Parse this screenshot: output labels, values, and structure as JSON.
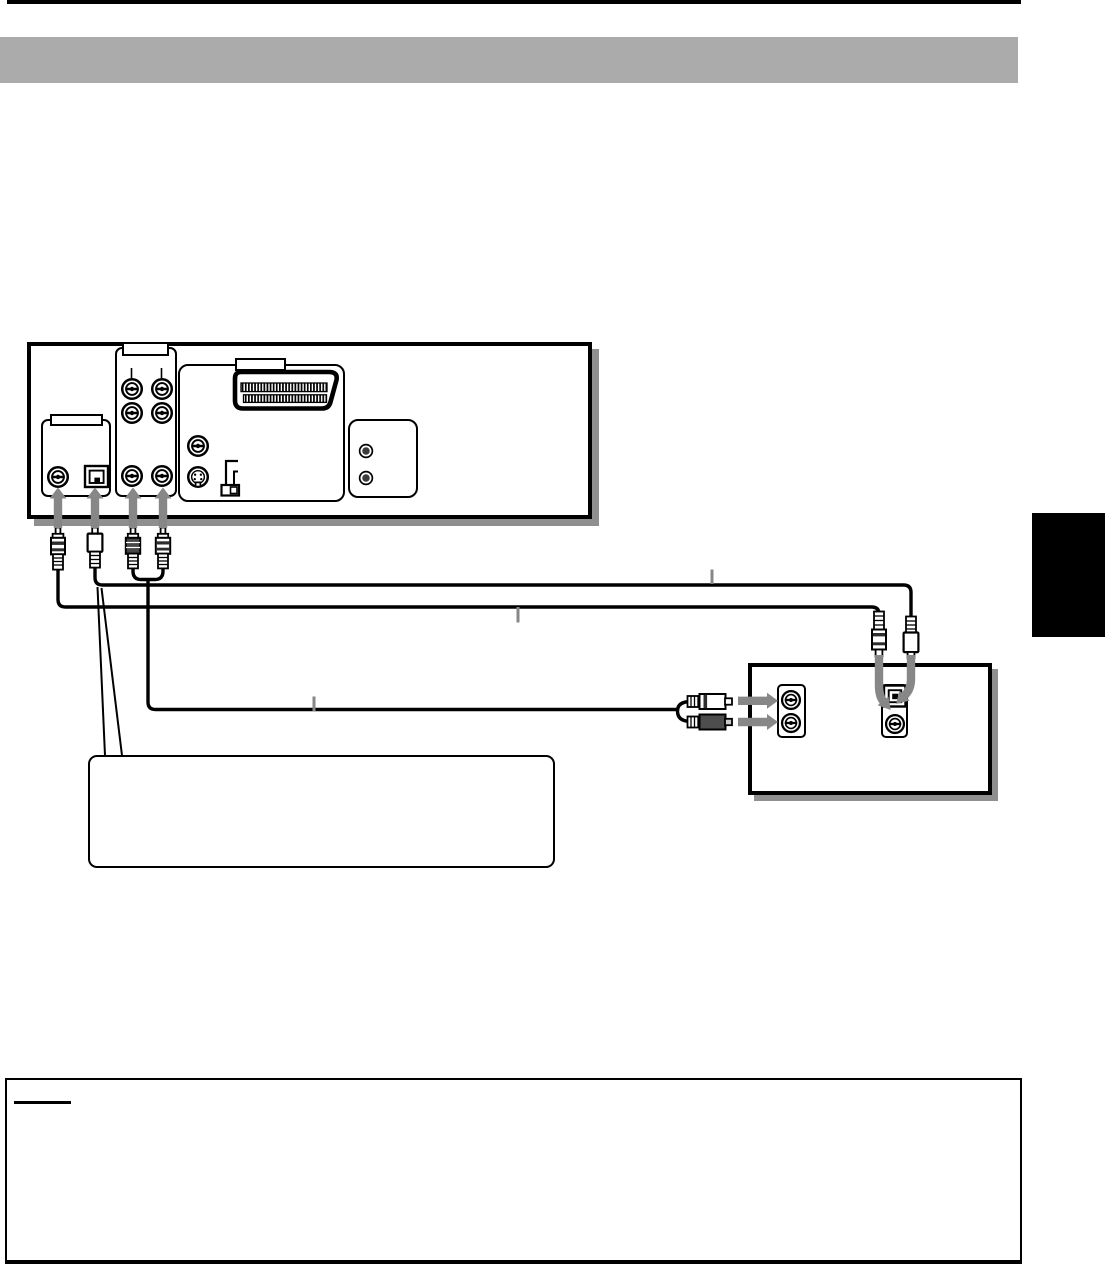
{
  "page": {
    "background": "#ffffff",
    "top_rule_color": "#000000",
    "header_band_color": "#ababab",
    "section_tab_color": "#000000",
    "shadow_color": "#8f8f8f",
    "arrow_color": "#878787",
    "line_color": "#000000"
  },
  "dvd_rear_panel": {
    "label_boxes": [
      {
        "text": ""
      },
      {
        "text": ""
      },
      {
        "text": ""
      }
    ],
    "jacks": [
      "coaxial-digital-out-rca",
      "optical-digital-out",
      "audio-out-rca-top-left",
      "audio-out-rca-top-right",
      "audio-out-rca-mid-left",
      "audio-out-rca-mid-right",
      "audio-out-rca-bottom-left",
      "audio-out-rca-bottom-right",
      "video-out-rca",
      "s-video-out",
      "scart-av-connector",
      "video-output-switch",
      "aux-phono-top",
      "aux-phono-bottom"
    ]
  },
  "amplifier_panel": {
    "jacks": [
      "audio-in-left-rca",
      "audio-in-right-rca",
      "optical-digital-in",
      "coaxial-digital-in"
    ]
  },
  "cables": [
    "coaxial-digital-cable",
    "optical-digital-cable",
    "stereo-audio-cable"
  ],
  "callout_box": {
    "text": ""
  },
  "notes_section": {
    "heading": "",
    "body": ""
  }
}
